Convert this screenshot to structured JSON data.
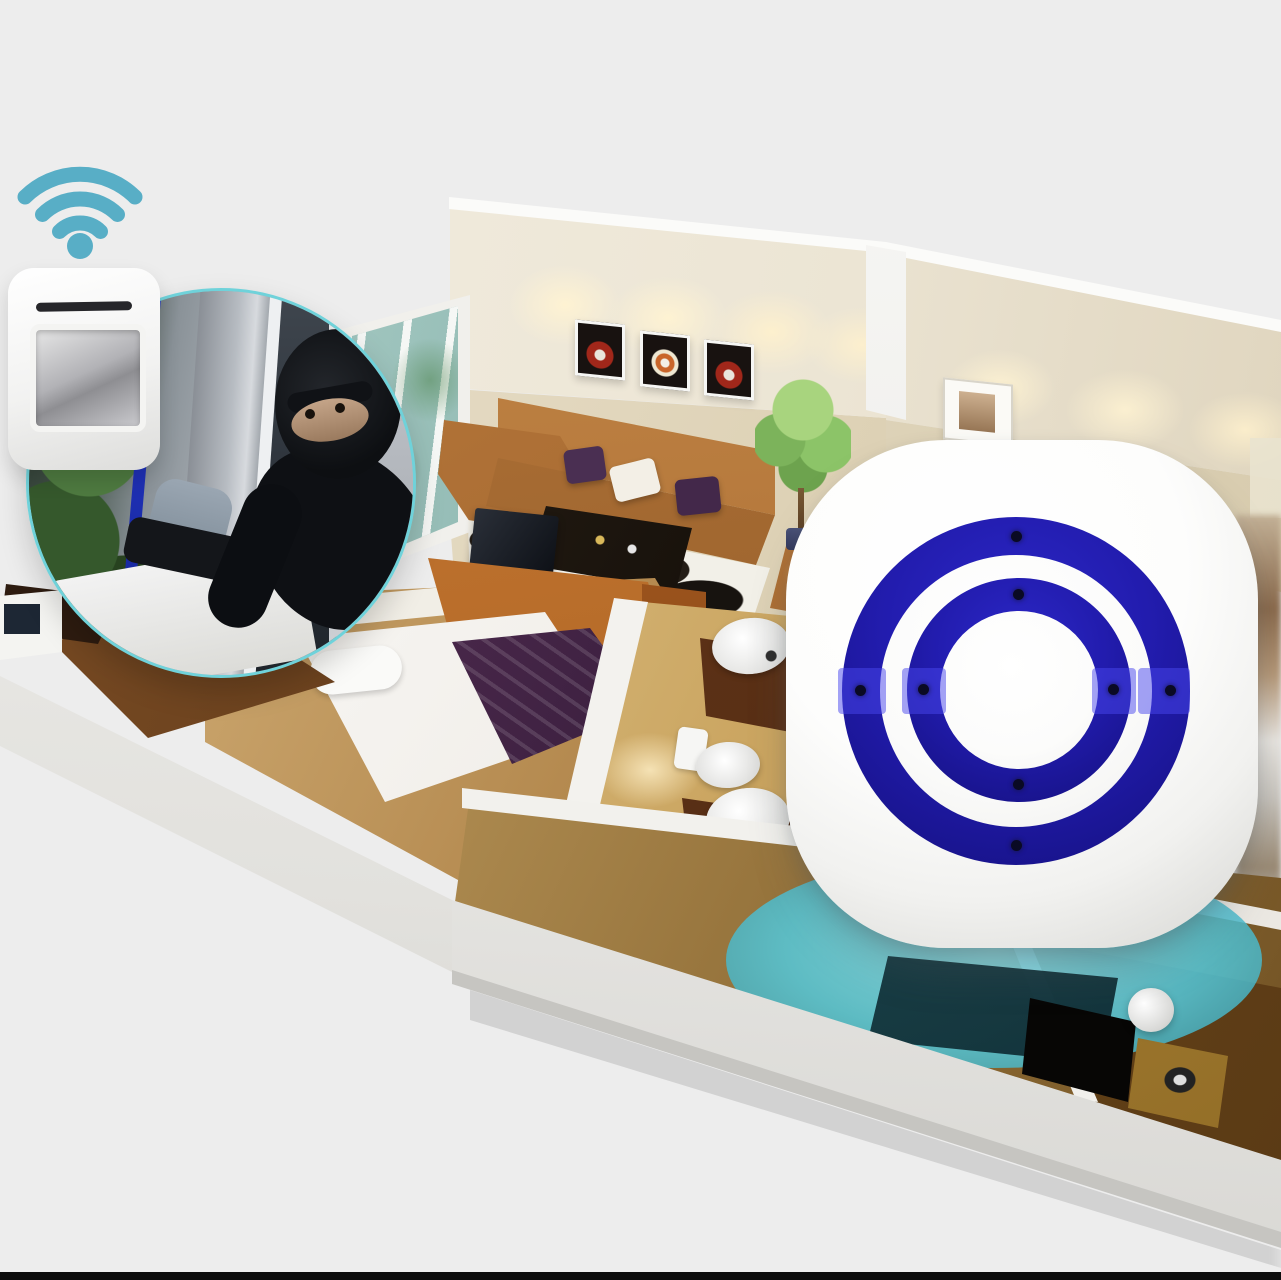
{
  "colors": {
    "background": "#ededed",
    "bottom_bar": "#0c0c0c",
    "wifi_teal": "#58aec6",
    "inset_border_teal": "#6fd2da",
    "detection_teal_a": "rgba(86,198,214,0.88)",
    "ring_blue": "#221cae",
    "ring_blue_bright": "#2c28c8",
    "ring_blue_deep": "#14107e",
    "led_dot": "#0a0a24",
    "device_white": "#ffffff",
    "wall_cream": "#ece5d4",
    "blanket_purple": "#3a1f3e",
    "wood_dark": "#4e2d12",
    "counter_brown": "#4a2610"
  },
  "icons": [
    {
      "name": "wifi-icon",
      "shape": "three-arcs-and-dot"
    },
    {
      "name": "alarm-ring-icon",
      "shape": "two-concentric-circles"
    }
  ],
  "labels": {
    "wifi_icon": "wireless-signal",
    "pir_sensor": "pir-motion-sensor-transmitter",
    "burglar_inset": "burglar-entering-window-inset",
    "alarm_receiver": "plug-in-alarm-receiver-with-blue-rings",
    "detection_zone": "motion-detection-zone",
    "floorplan": "isometric-apartment-floorplan",
    "living_room": "living-room",
    "bedroom": "bedroom",
    "bathroom": "bathroom"
  },
  "alarm_receiver": {
    "ring_count": 2,
    "led_count": 8
  },
  "wifi_signal": {
    "arc_count": 3
  }
}
